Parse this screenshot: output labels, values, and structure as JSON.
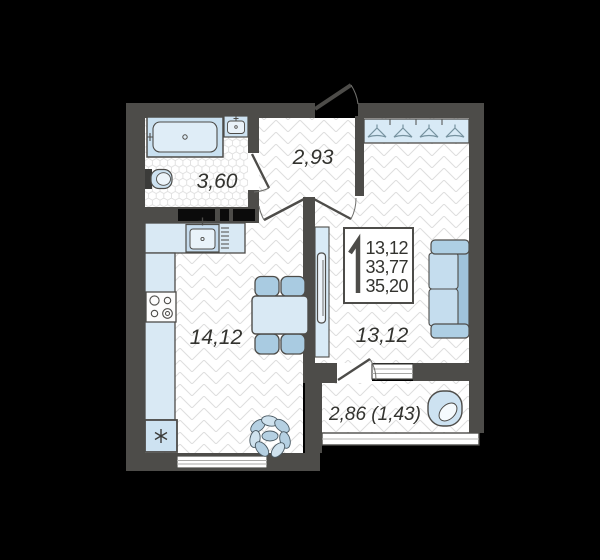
{
  "title": "1-room apartment floor plan",
  "badge": {
    "rooms_count": "1",
    "lines": [
      "13,12",
      "33,77",
      "35,20"
    ]
  },
  "rooms": {
    "bathroom": {
      "area": "3,60"
    },
    "hallway": {
      "area": "2,93"
    },
    "kitchen_living": {
      "area": "14,12"
    },
    "living_room": {
      "area": "13,12"
    },
    "balcony": {
      "area": "2,86 (1,43)"
    }
  },
  "icons": {
    "wardrobe": "hanger-icon",
    "fridge": "snowflake-icon",
    "bathtub": "bathtub-icon",
    "toilet": "toilet-icon",
    "sink": "sink-icon",
    "stove": "stove-burners-icon",
    "sofa": "sofa-icon",
    "armchair": "armchair-icon",
    "plant": "plant-icon",
    "tv": "tv-icon"
  },
  "colors": {
    "background": "#000000",
    "wall": "#4d4c49",
    "floor": "#ffffff",
    "floor_pattern_line": "#dedede",
    "furniture_light_blue": "#cde2f1",
    "furniture_mid_blue": "#aecfe4",
    "furniture_deep_blue": "#9fc3db",
    "label_text": "#33332f"
  }
}
